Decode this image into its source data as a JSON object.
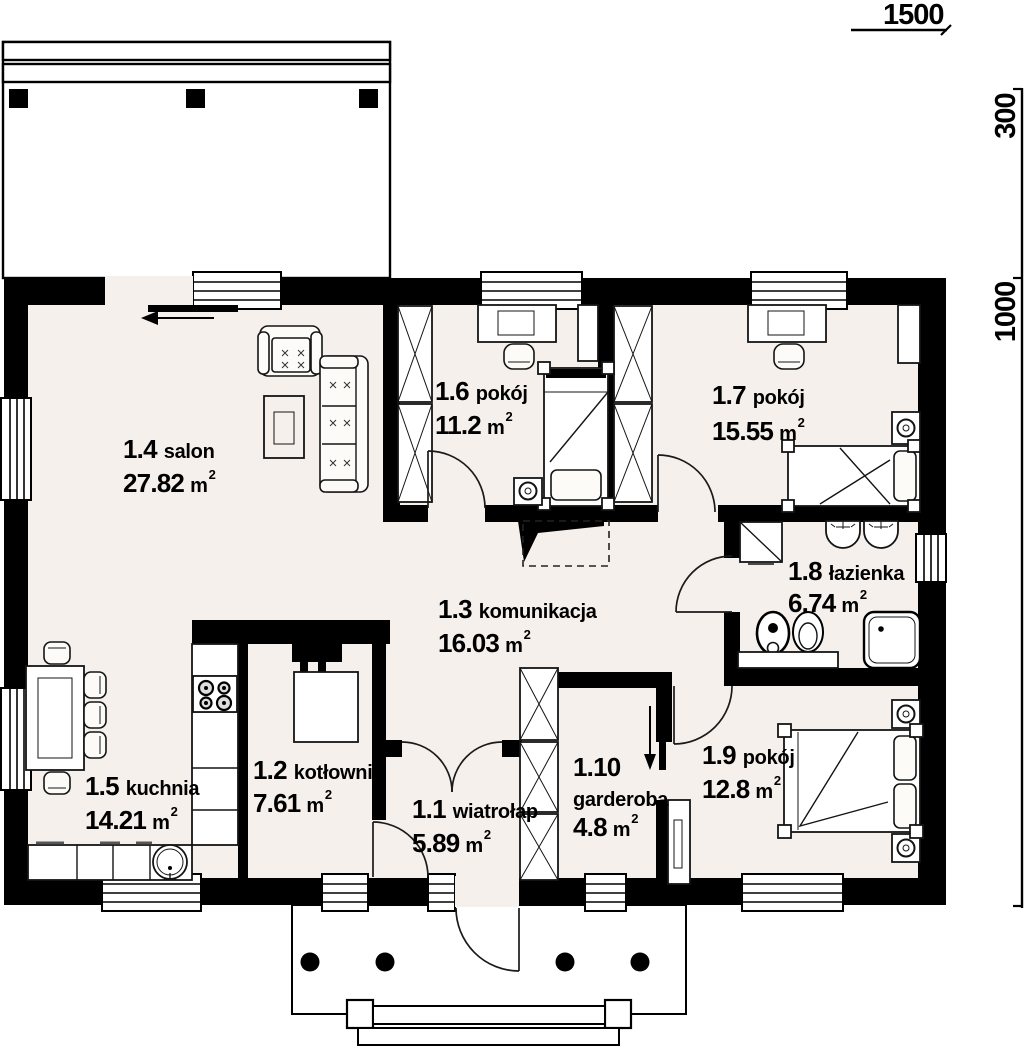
{
  "title": "floor plan",
  "area_superscript": "2",
  "dimensions": {
    "width_label": "1500",
    "terrace_depth_label": "300",
    "house_depth_label": "1000"
  },
  "rooms": [
    {
      "id": "1.1",
      "name": "wiatrołap",
      "area": "5.89",
      "unit": "m"
    },
    {
      "id": "1.2",
      "name": "kotłownia",
      "area": "7.61",
      "unit": "m"
    },
    {
      "id": "1.3",
      "name": "komunikacja",
      "area": "16.03",
      "unit": "m"
    },
    {
      "id": "1.4",
      "name": "salon",
      "area": "27.82",
      "unit": "m"
    },
    {
      "id": "1.5",
      "name": "kuchnia",
      "area": "14.21",
      "unit": "m"
    },
    {
      "id": "1.6",
      "name": "pokój",
      "area": "11.2",
      "unit": "m"
    },
    {
      "id": "1.7",
      "name": "pokój",
      "area": "15.55",
      "unit": "m"
    },
    {
      "id": "1.8",
      "name": "łazienka",
      "area": "6.74",
      "unit": "m"
    },
    {
      "id": "1.9",
      "name": "pokój",
      "area": "12.8",
      "unit": "m"
    },
    {
      "id": "1.10",
      "name": "garderoba",
      "area": "4.8",
      "unit": "m"
    }
  ],
  "colors": {
    "wall": "#000000",
    "floor": "#f6f0ec",
    "background": "#ffffff"
  }
}
